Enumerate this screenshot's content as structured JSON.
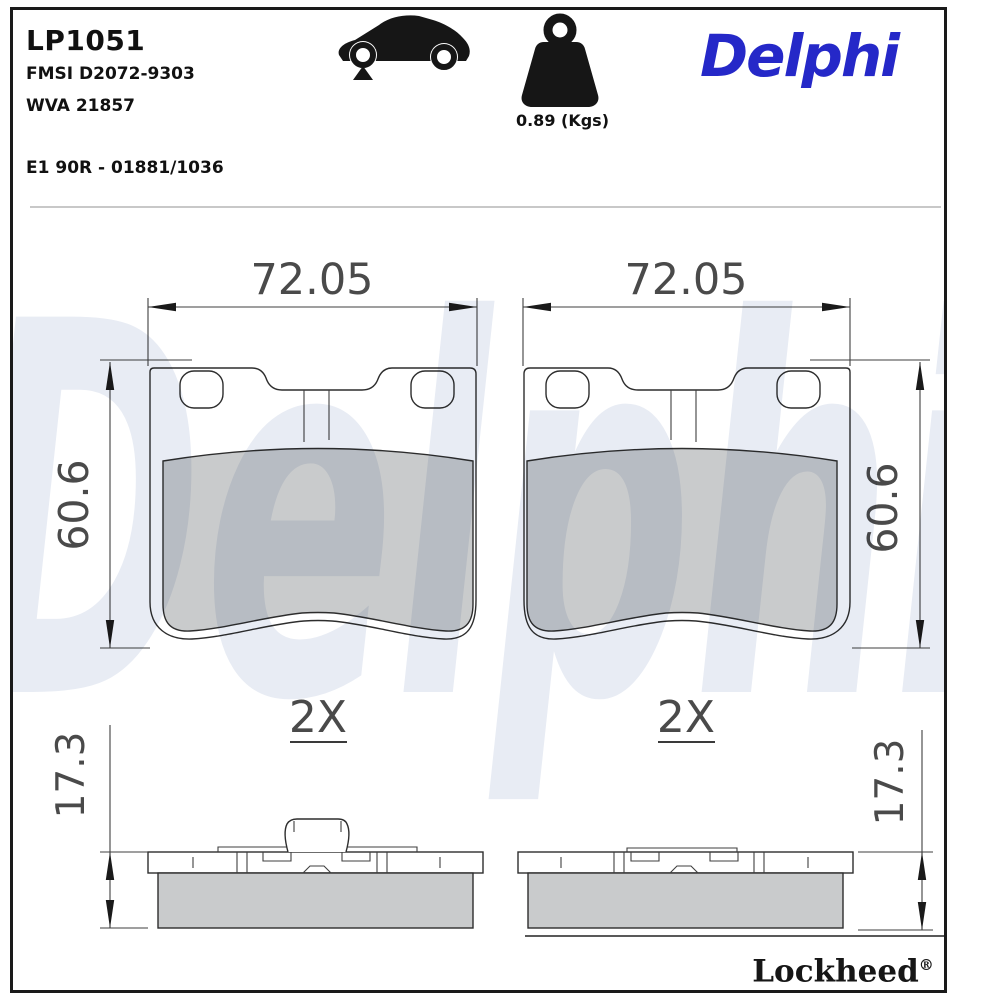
{
  "document": {
    "part_number": "LP1051",
    "fmsi_code": "FMSI D2072-9303",
    "wva_code": "WVA 21857",
    "approval_code": "E1 90R - 01881/1036",
    "weight_label": "0.89 (Kgs)",
    "brand_logo": "Delphi",
    "footer_brand": "Lockheed",
    "footer_reg_mark": "®",
    "watermark_text": "Delphi"
  },
  "dimensions": {
    "pad_width": "72.05",
    "pad_height": "60.6",
    "pad_thickness": "17.3",
    "quantity_note": "2X"
  },
  "icons": {
    "vehicle": "car-side-silhouette-with-front-axle-marker",
    "weight": "weight-block-with-ring"
  },
  "colors": {
    "brand_blue": "#2528c8",
    "friction_gray": "#c9cbcc",
    "outline_dark": "#2d2d2d",
    "dimension_gray": "#4a4a4a",
    "watermark_blue": "#e8ecf4",
    "separator_gray": "#b5b5b5"
  }
}
